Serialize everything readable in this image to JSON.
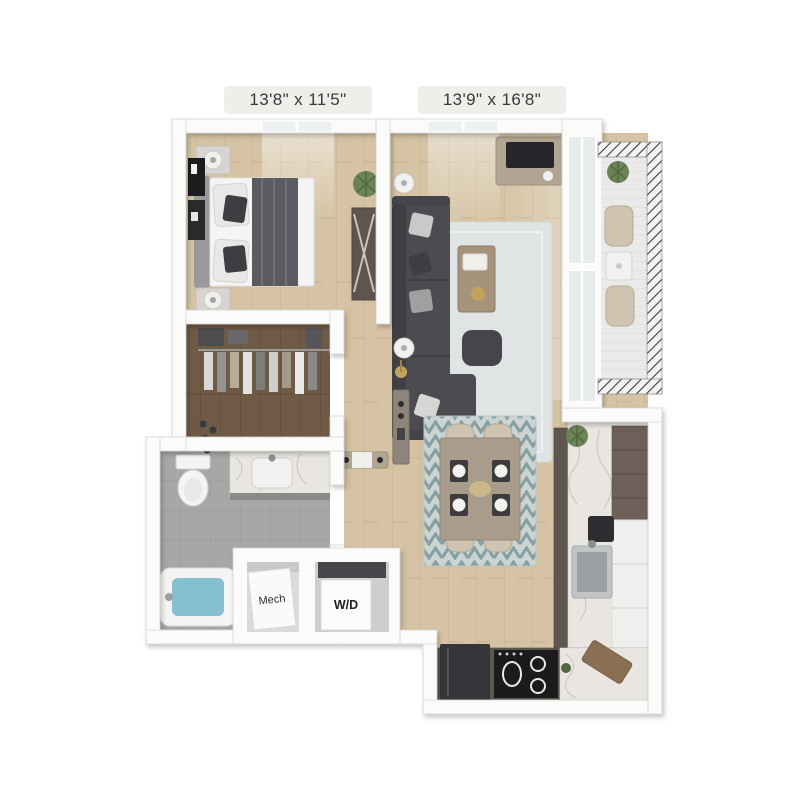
{
  "page": {
    "background": "#ffffff",
    "type": "3d-floor-plan-rendering"
  },
  "floorplan": {
    "labels": {
      "bedroom_dimensions": "13'8\" x 11'5\"",
      "living_dimensions": "13'9\" x 16'8\"",
      "mech_closet": "Mech",
      "washer_dryer": "W/D"
    },
    "palette": {
      "wall": "#fbfbfa",
      "wall_edge": "#d8d6d2",
      "wood_floor": "#d5c3a3",
      "wood_line": "#c3b190",
      "closet_floor": "#6f5a45",
      "closet_line": "#5c4837",
      "tile": "#a7a7a5",
      "tile_line": "#999997",
      "rug_living": "#e0e4e4",
      "rug_dining": "#ccd4d2",
      "rug_dining_accent": "#84a0a4",
      "sofa": "#4b4b50",
      "sofa_dark": "#3f3f44",
      "mattress": "#f4f4f2",
      "headboard": "#9a9a9c",
      "blanket": "#5b5c61",
      "pillow_dark": "#3e3e42",
      "cabinet": "#6e6059",
      "cabinet_dark": "#5d5750",
      "counter": "#e9e6e1",
      "counter_vein": "#c6c2bc",
      "appliance_dark": "#1b1b1e",
      "steel": "#c2c5c7",
      "steel_dark": "#9aa0a2",
      "tub_water": "#84bfd2",
      "balcony_floor": "#eaeae8",
      "railing": "#3f3f3f",
      "chair_beige": "#cfc4b0",
      "table_wood": "#a99c8b",
      "dresser_wood": "#5f554e",
      "console_tan": "#b3a593",
      "plant_green": "#6a8458",
      "plant_dark": "#50663c",
      "gold": "#c2a35a",
      "label_bg": "#efeeeb",
      "label_text": "#3a3a3a",
      "fixture_white": "#f4f4f2"
    }
  }
}
